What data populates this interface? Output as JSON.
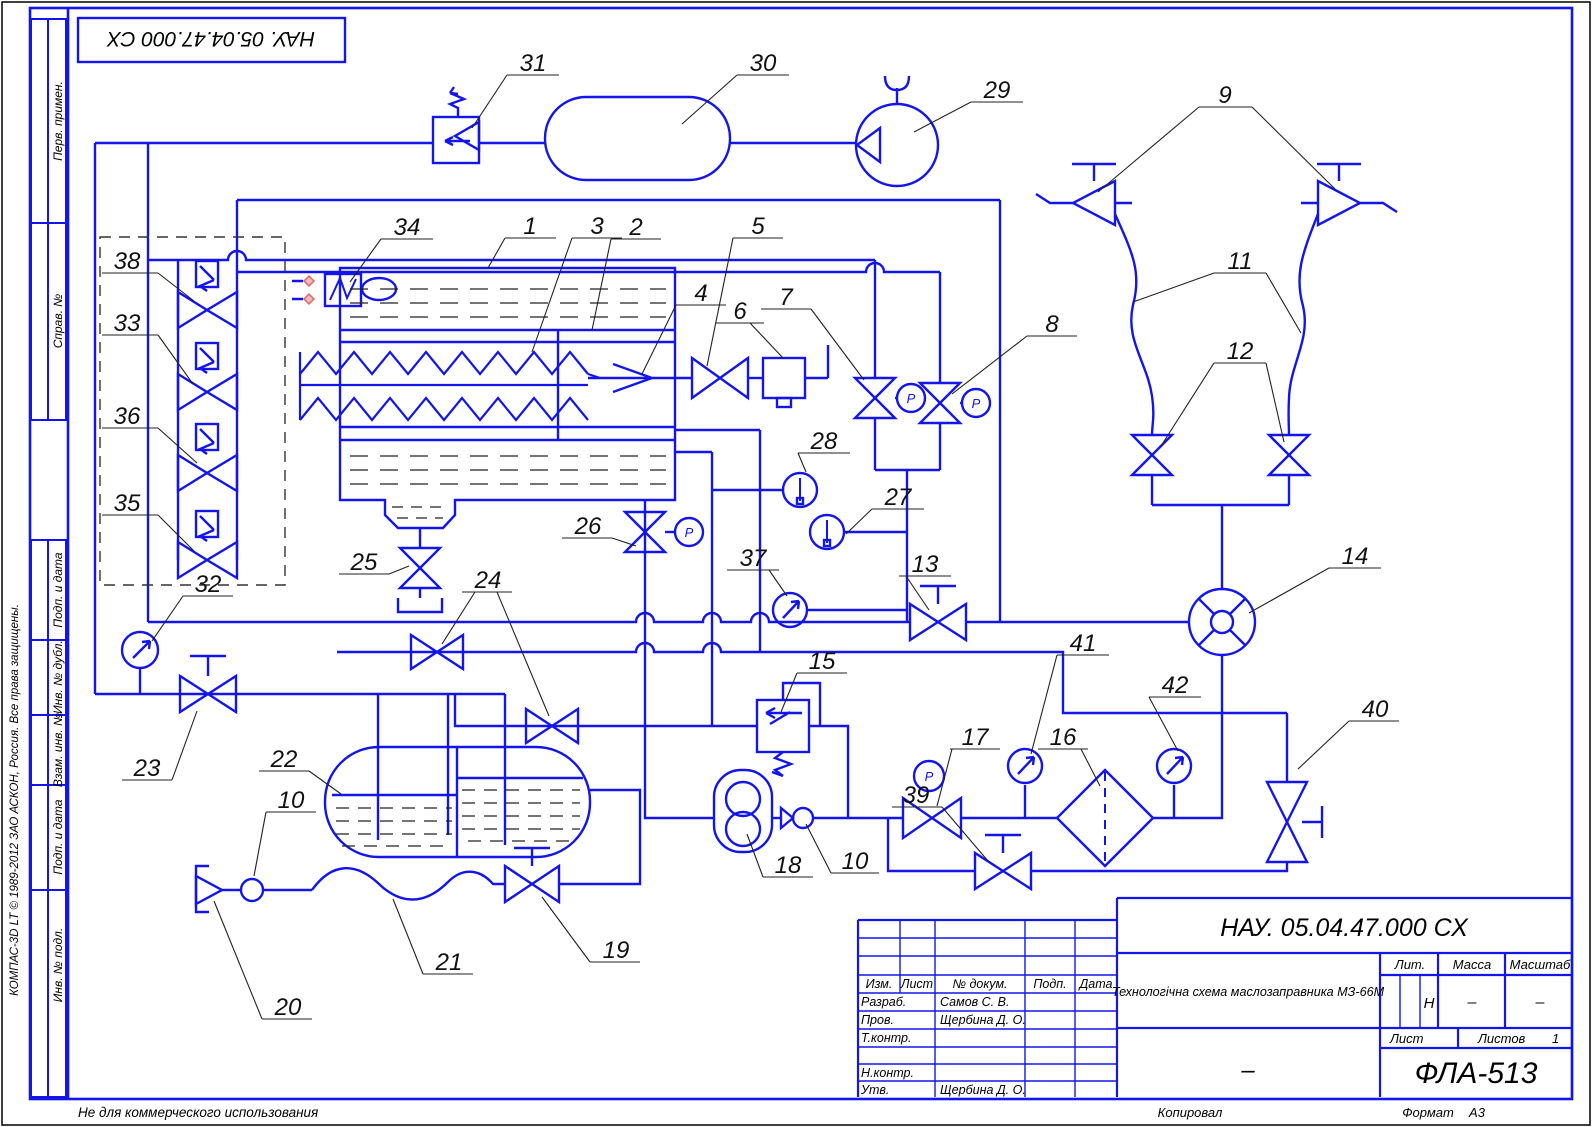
{
  "page": {
    "accent_blue": "#1315ea",
    "note_bottom": "Не для коммерческого использования",
    "copyright": "КОМПАС-3D LT © 1989-2012 ЗАО АСКОН, Россия. Все права защищены."
  },
  "stamp_top": {
    "doc_code_rotated": "НАУ. 05.04.47.000 СХ"
  },
  "sidebar": {
    "s1": "Перв. примен.",
    "s2": "Справ. №",
    "s3": "Подп. и дата",
    "s4": "Инв. № дубл.",
    "s5": "Взам. инв. №",
    "s6": "Подп. и дата",
    "s7": "Инв. № подл."
  },
  "titleblock": {
    "doc_code": "НАУ. 05.04.47.000 СХ",
    "title": "Технологічна схема маслозаправника МЗ-66М",
    "cols": {
      "izm": "Изм.",
      "list": "Лист",
      "ndoc": "№ докум.",
      "podp": "Подп.",
      "data": "Дата"
    },
    "rows": {
      "razrab": "Разраб.",
      "prov": "Пров.",
      "tkontr": "Т.контр.",
      "nkontr": "Н.контр.",
      "utv": "Утв."
    },
    "names": {
      "razrab": "Самов С. В.",
      "prov": "Щербина Д. О.",
      "utv": "Щербина Д. О."
    },
    "lit_label": "Лит.",
    "lit_value": "Н",
    "massa_label": "Масса",
    "massa_value": "–",
    "masshtab_label": "Масштаб",
    "masshtab_value": "–",
    "list_label": "Лист",
    "listov_label": "Листов",
    "listov_value": "1",
    "org": "ФЛА-513",
    "dash": "–",
    "kopiroval": "Копировал",
    "format_label": "Формат",
    "format_value": "А3"
  },
  "schematic": {
    "p_label": "P",
    "labels": {
      "n1": "1",
      "n2": "2",
      "n3": "3",
      "n4": "4",
      "n5": "5",
      "n6": "6",
      "n7": "7",
      "n8": "8",
      "n9": "9",
      "n10": "10",
      "n11": "11",
      "n12": "12",
      "n13": "13",
      "n14": "14",
      "n15": "15",
      "n16": "16",
      "n17": "17",
      "n18": "18",
      "n19": "19",
      "n20": "20",
      "n21": "21",
      "n22": "22",
      "n23": "23",
      "n24": "24",
      "n25": "25",
      "n26": "26",
      "n27": "27",
      "n28": "28",
      "n29": "29",
      "n30": "30",
      "n31": "31",
      "n32": "32",
      "n33": "33",
      "n34": "34",
      "n35": "35",
      "n36": "36",
      "n37": "37",
      "n38": "38",
      "n39": "39",
      "n40": "40",
      "n41": "41",
      "n42": "42"
    }
  }
}
